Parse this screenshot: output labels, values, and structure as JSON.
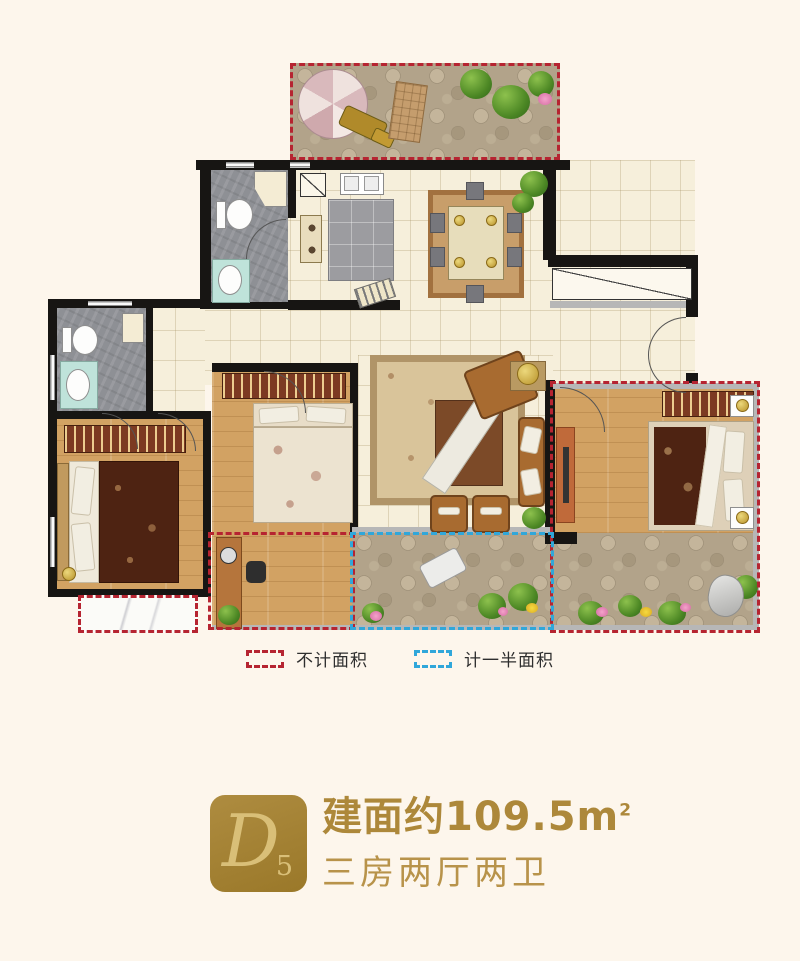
{
  "legend": {
    "items": [
      {
        "id": "excluded",
        "label": "不计面积"
      },
      {
        "id": "half_counted",
        "label": "计一半面积"
      }
    ]
  },
  "unit": {
    "badge_letter": "D",
    "badge_number": "5",
    "area_label": "建面约109.5",
    "area_unit": "m",
    "area_unit_exponent": "2",
    "layout": "三房两厅两卫"
  },
  "colors": {
    "background": "#fdf6ec",
    "badge_gold": "#a5822f",
    "badge_text_gold": "#d9bf78",
    "title_gold": "#ad883a",
    "subtitle_gold": "#b8934a",
    "excluded_dash_red": "#b62431",
    "half_dash_blue": "#30a7da"
  }
}
